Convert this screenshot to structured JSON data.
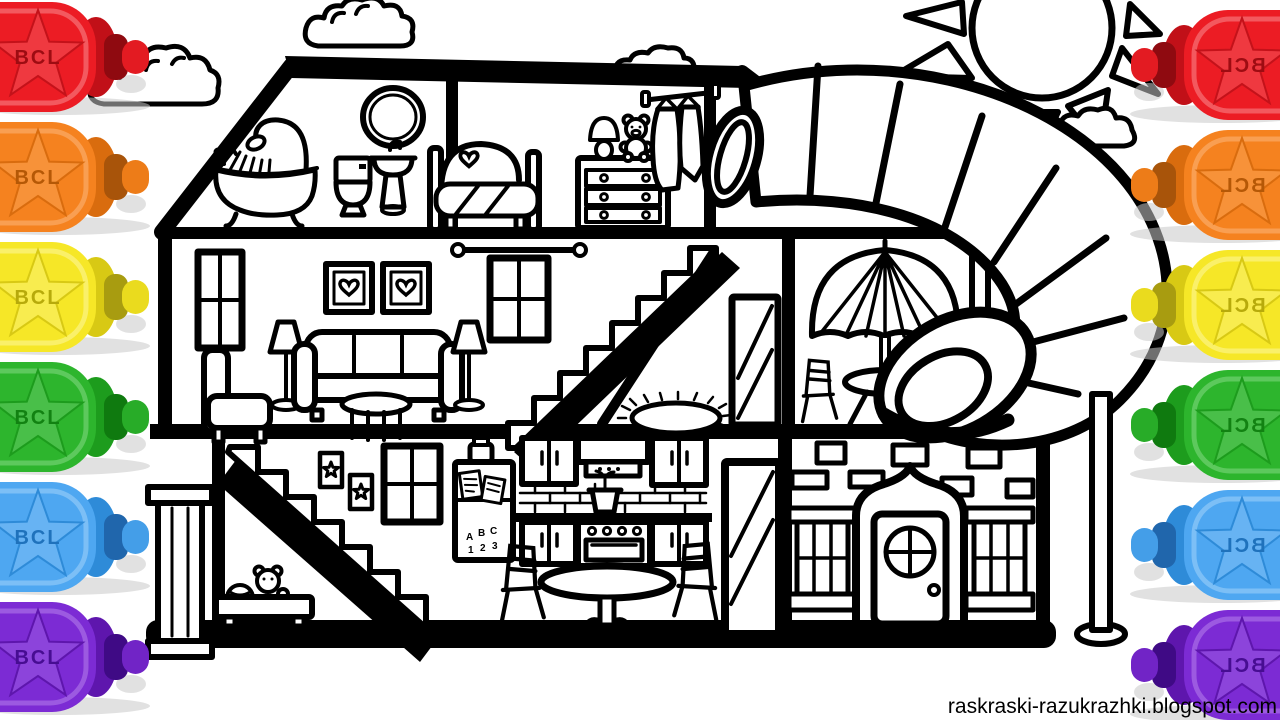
{
  "page": {
    "watermark": "raskraski-razukrazhki.blogspot.com",
    "background": "#ffffff",
    "ink": "#000000"
  },
  "markers": {
    "label": "BCL",
    "left_tops": [
      0,
      120,
      240,
      360,
      480,
      600
    ],
    "right_tops": [
      8,
      128,
      248,
      368,
      488,
      608
    ],
    "colors": [
      {
        "name": "red",
        "body": "#EC1C24",
        "rim": "#F4646A",
        "star": "#EF3940",
        "star_edge": "#C4121A",
        "label_color": "#9E0C12",
        "tip_dark": "#C11018",
        "tip_mid": "#8F0A10",
        "tip_bright": "#E31B22"
      },
      {
        "name": "orange",
        "body": "#F5821F",
        "rim": "#F9A45C",
        "star": "#F79239",
        "star_edge": "#D96C0E",
        "label_color": "#B55806",
        "tip_dark": "#D96C0E",
        "tip_mid": "#A8540A",
        "tip_bright": "#ED7C18"
      },
      {
        "name": "yellow",
        "body": "#F6E727",
        "rim": "#FAF176",
        "star": "#F8EC4F",
        "star_edge": "#D8C914",
        "label_color": "#B7AA0B",
        "tip_dark": "#D8C914",
        "tip_mid": "#A89C10",
        "tip_bright": "#EADB1E"
      },
      {
        "name": "green",
        "body": "#2DB52D",
        "rim": "#66CC66",
        "star": "#49BF49",
        "star_edge": "#1D9C1D",
        "label_color": "#128212",
        "tip_dark": "#1D9C1D",
        "tip_mid": "#0F7A0F",
        "tip_bright": "#28AC28"
      },
      {
        "name": "blue",
        "body": "#4EA7F1",
        "rim": "#85C3F7",
        "star": "#67B3F3",
        "star_edge": "#2E8BD8",
        "label_color": "#1F72BC",
        "tip_dark": "#2E8BD8",
        "tip_mid": "#2066AC",
        "tip_bright": "#449EE8"
      },
      {
        "name": "purple",
        "body": "#7C2BD4",
        "rim": "#A263E3",
        "star": "#8C44DB",
        "star_edge": "#5E16AD",
        "label_color": "#470D92",
        "tip_dark": "#5E16AD",
        "tip_mid": "#3F0A85",
        "tip_bright": "#7124C6"
      }
    ]
  },
  "kitchen": {
    "magnets": [
      "A",
      "B",
      "C",
      "1",
      "2",
      "3"
    ]
  },
  "scene": {
    "objects": [
      "sun",
      "clouds",
      "water-slide",
      "slide-entry-ring",
      "slide-pole",
      "bathtub",
      "shower",
      "toilet",
      "pedestal-sink",
      "oval-mirror",
      "bed",
      "dresser",
      "table-lamp",
      "teddy-bear",
      "clothes-rack",
      "sofa",
      "armchair",
      "floor-lamp",
      "heart-pictures",
      "windows",
      "curtain-rod",
      "coffee-table",
      "upper-staircase",
      "lower-staircase",
      "fringed-rug",
      "patio-umbrella",
      "patio-table",
      "patio-chairs",
      "interior-doors",
      "greek-column",
      "toy-bench",
      "ball",
      "star-pictures",
      "refrigerator",
      "kitchen-cabinets",
      "range-hood",
      "stove",
      "dining-table",
      "dining-chairs",
      "brick-facade",
      "front-door",
      "facade-windows"
    ]
  }
}
